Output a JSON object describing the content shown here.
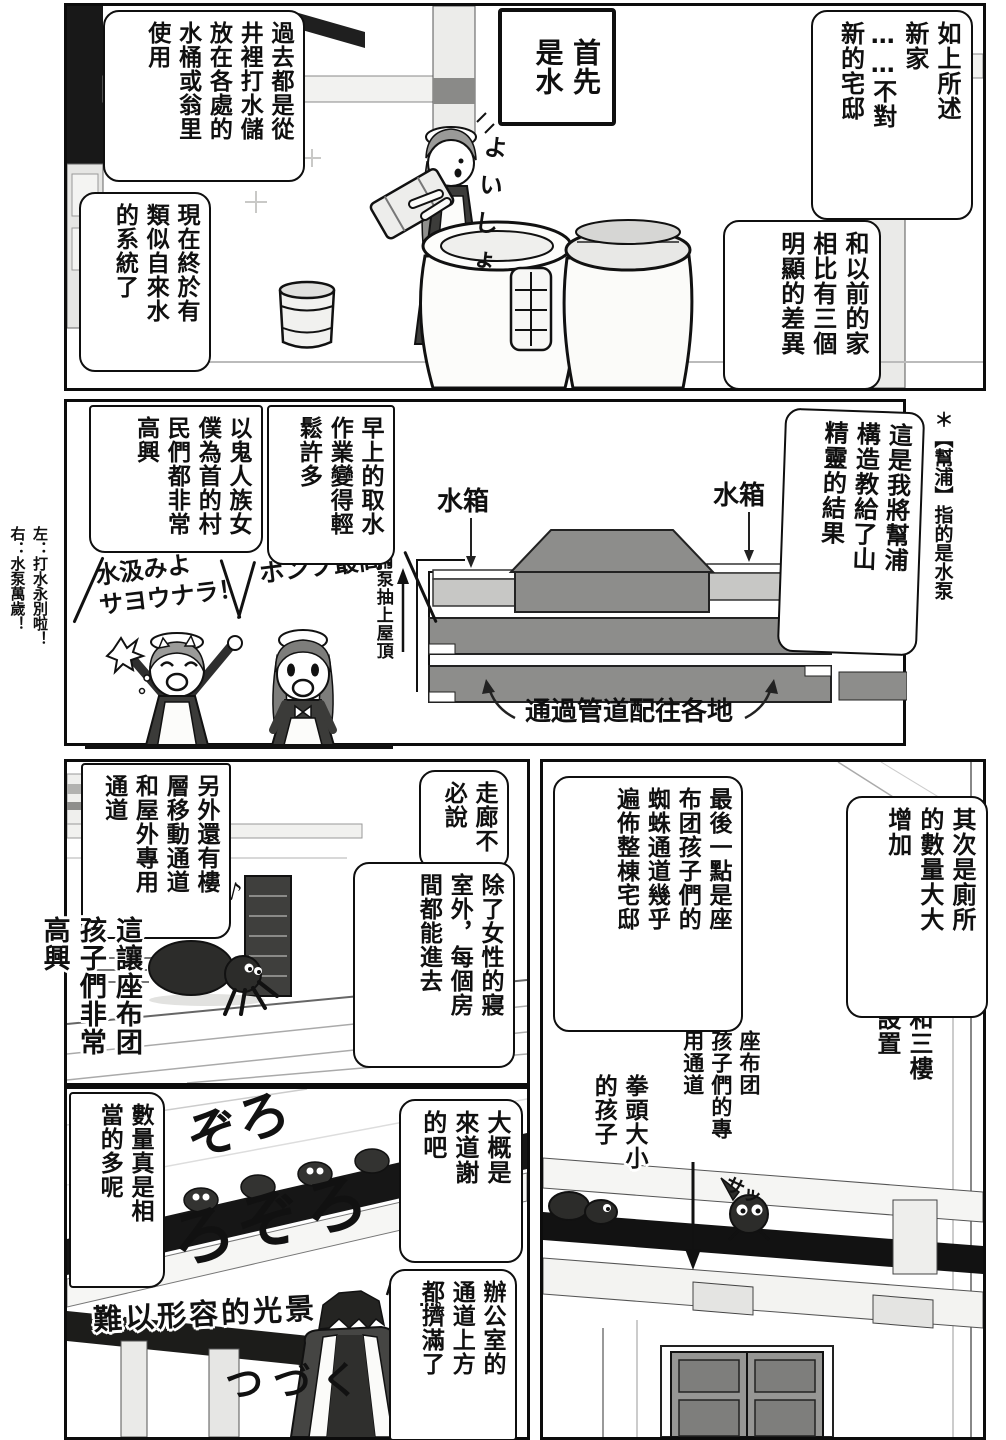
{
  "palette": {
    "ink": "#101010",
    "beam_black": "#161616",
    "mid_gray": "#8d8d8b",
    "tank_gray": "#c7c7c5",
    "paper": "#ffffff"
  },
  "margins": {
    "pump_footnote": "＊【幫浦】指的是水泵",
    "translator_note": "左：打水永別啦！\n右：水泵萬歲！"
  },
  "panel1": {
    "bubble_intro": "如上所述\n新家\n……不對\n新的宅邸",
    "bubble_compare": "和以前的家\n相比有三個\n明顯的差異",
    "box_first": "首先\n是水",
    "bubble_past": "過去都是從\n井裡打水儲\n放在各處的\n水桶或翁里\n使用",
    "bubble_now": "現在終於有\n類似自來水\n的系統了",
    "sfx_yoisho": "よいしょ"
  },
  "panel2": {
    "bubble_result": "這是我將幫浦\n構造教給了山\n精靈的結果",
    "bubble_morning": "早上的取水\n作業變得輕\n鬆許多",
    "bubble_villagers": "以鬼人族女\n僕為首的村\n民們都非常\n高興",
    "sfx_goodbye_fetching": "水汲みよ\nサヨウナラ！",
    "sfx_pump_best": "ポンプ最高!",
    "diagram": {
      "tank_left": "水箱",
      "tank_right": "水箱",
      "pump_pipe": "用泵抽上屋頂",
      "distribution": "通過管道配往各地"
    }
  },
  "panel3": {
    "bubble_toilets": "其次是廁所\n的數量大大\n增加",
    "caption_floors": "二樓和三樓\n也有設置",
    "bubble_spiderways": "最後一點是座\n布团孩子們的\n蜘蛛通道幾乎\n遍佈整棟宅邸",
    "label_passage": "座布团\n孩子們的專\n用通道",
    "label_fist_size": "拳頭大小\n的孩子",
    "sfx_sa": "サッ"
  },
  "panel4": {
    "bubble_passages": "另外還有樓\n層移動通道\n和屋外專用\n通道",
    "bubble_corridor": "走廊不\n必說",
    "bubble_rooms": "除了女性的寢\n室外，每個房\n間都能進去",
    "caption_happy": "這讓座布团\n孩子們非常\n高興",
    "sfx_note": "♪"
  },
  "panel5": {
    "bubble_count": "數量真是相\n當的多呢",
    "bubble_thanks": "大概是\n來道謝\n的吧",
    "bubble_office": "辦公室的\n通道上方\n都擠滿了",
    "sfx_zoro_small": "ぞろ",
    "sfx_zoro_big": "ぞろぞろ",
    "caption_scene": "難以形容的光景",
    "caption_scene_dots": "…。",
    "tsuzuku": "つづく"
  }
}
